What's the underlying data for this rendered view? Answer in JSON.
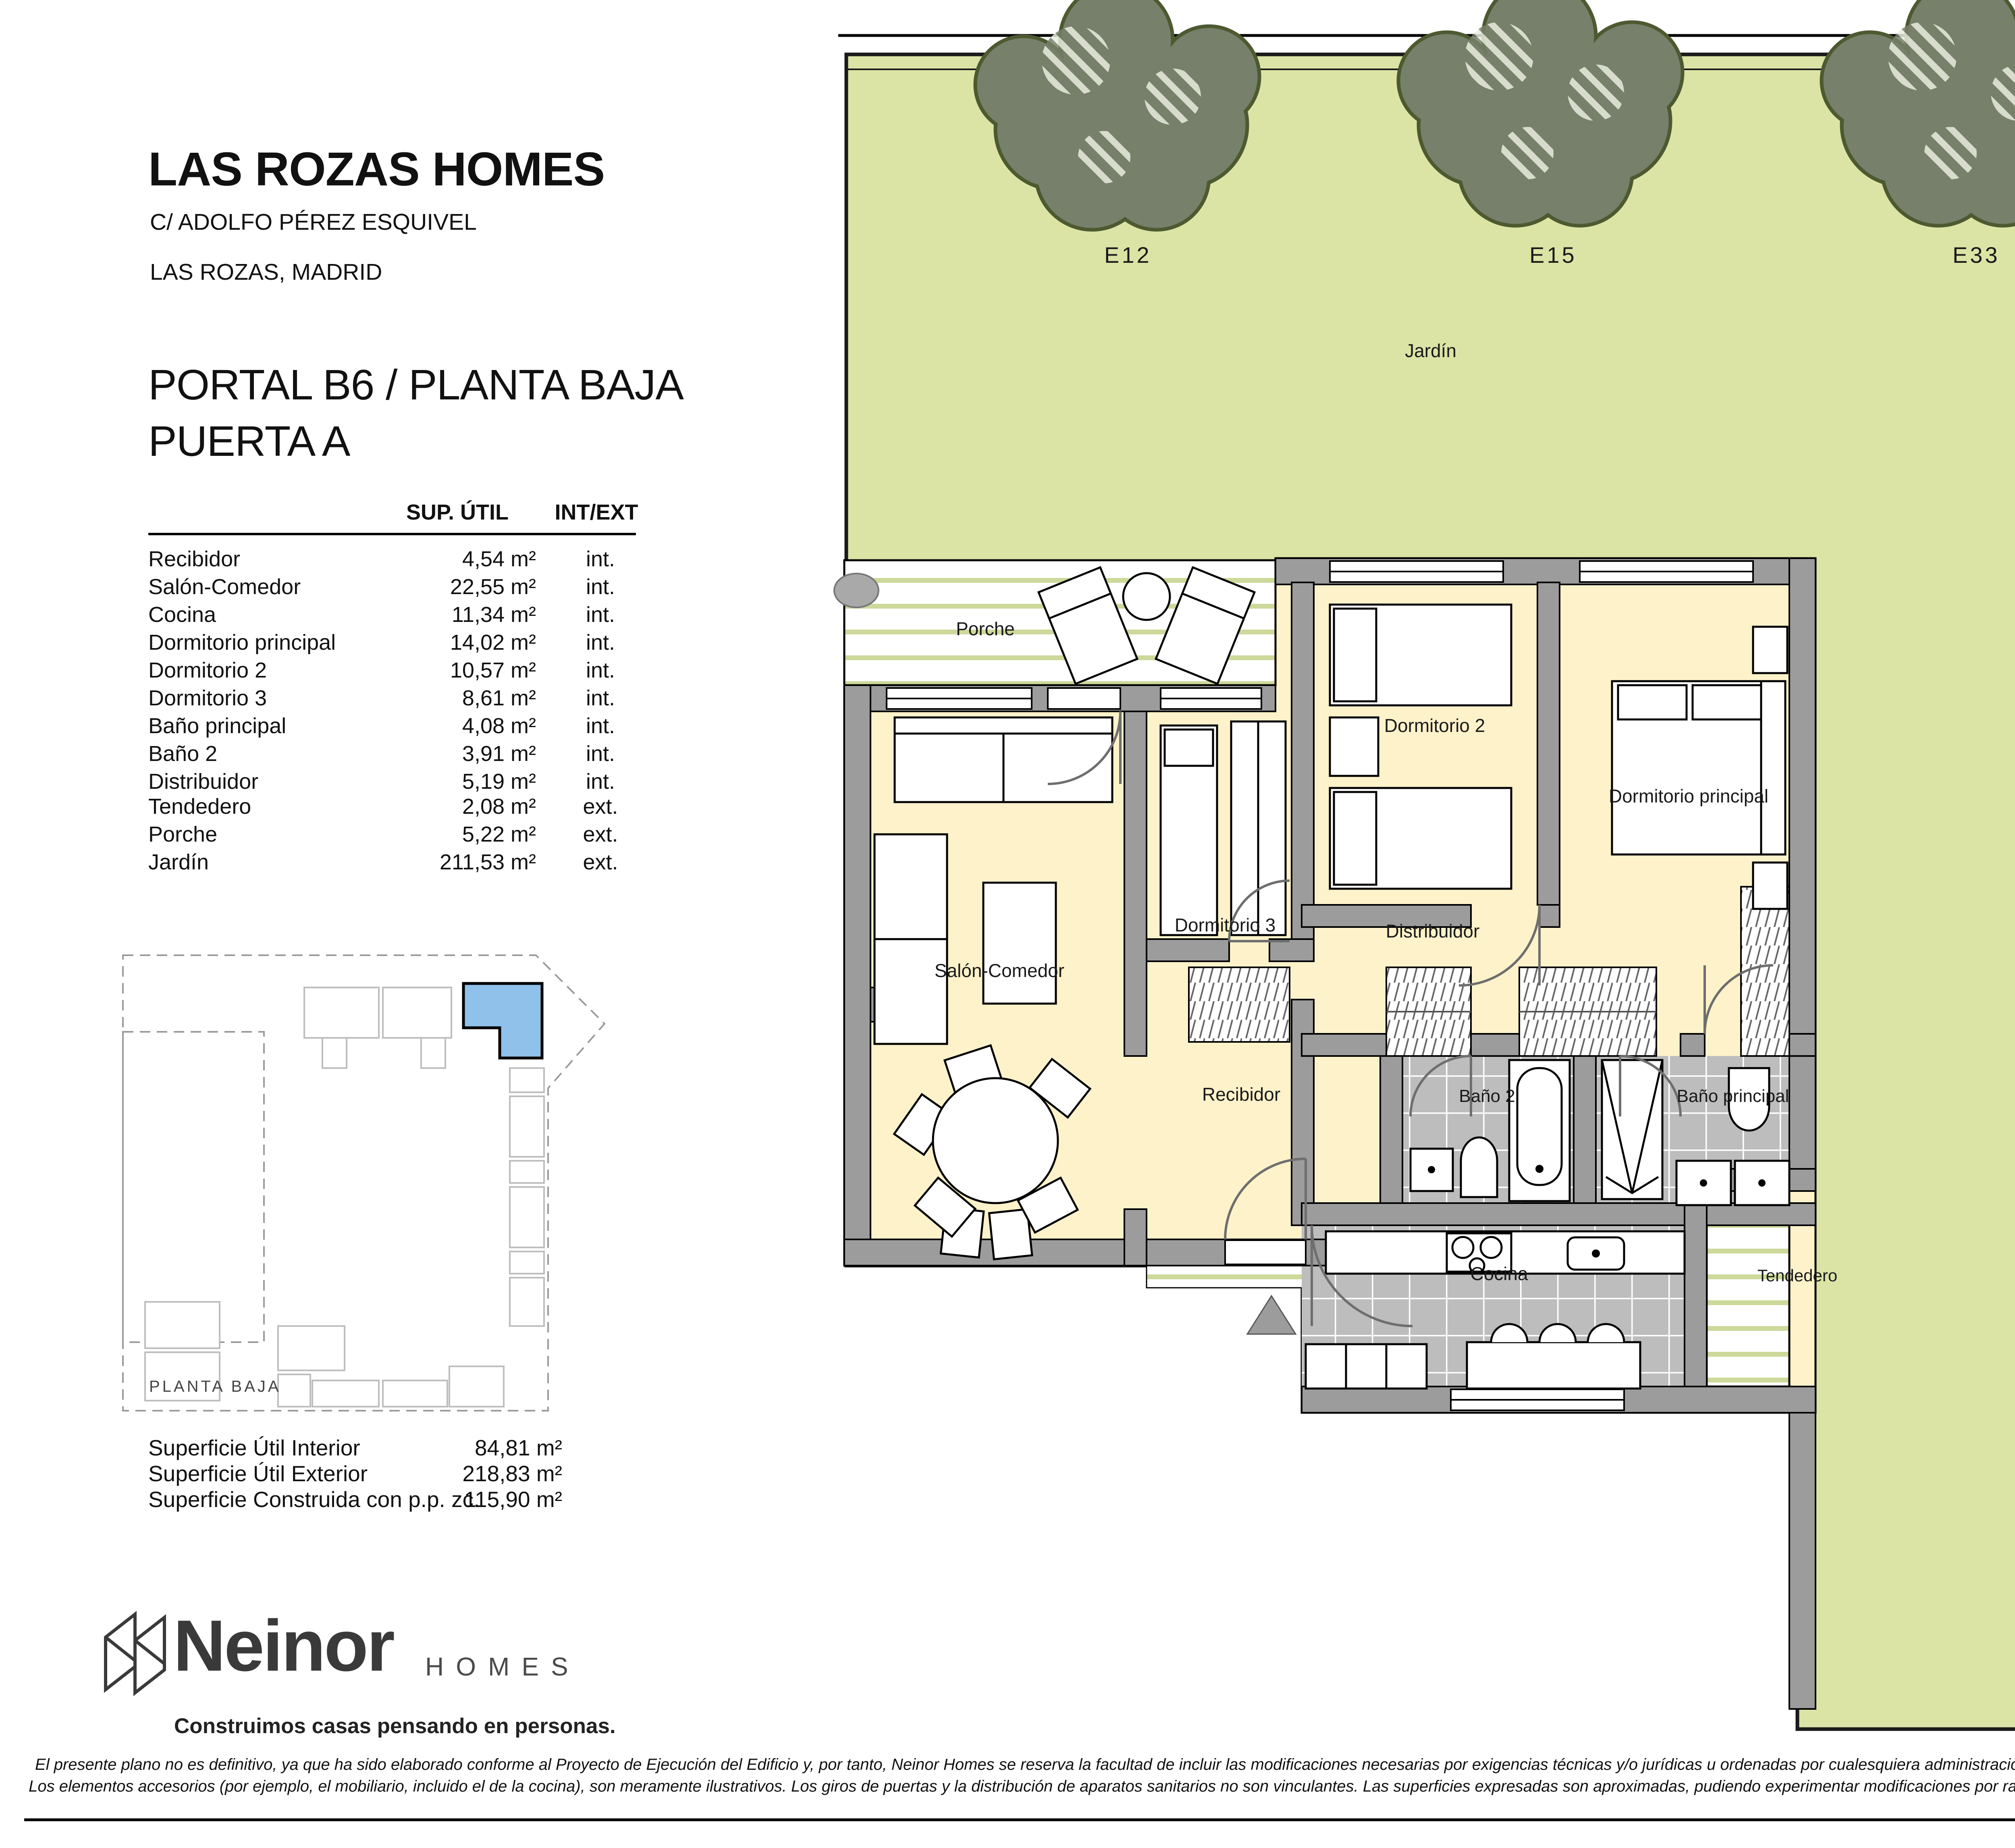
{
  "header": {
    "project": "LAS ROZAS HOMES",
    "address_line1": "C/ ADOLFO PÉREZ ESQUIVEL",
    "address_line2": "LAS ROZAS, MADRID",
    "unit_line1": "PORTAL B6 / PLANTA BAJA",
    "unit_line2": "PUERTA A"
  },
  "areas_table": {
    "col_area": "SUP. ÚTIL",
    "col_type": "INT/EXT",
    "rows": [
      {
        "name": "Recibidor",
        "area": "4,54 m²",
        "type": "int."
      },
      {
        "name": "Salón-Comedor",
        "area": "22,55 m²",
        "type": "int."
      },
      {
        "name": "Cocina",
        "area": "11,34 m²",
        "type": "int."
      },
      {
        "name": "Dormitorio principal",
        "area": "14,02 m²",
        "type": "int."
      },
      {
        "name": "Dormitorio 2",
        "area": "10,57 m²",
        "type": "int."
      },
      {
        "name": "Dormitorio 3",
        "area": "8,61 m²",
        "type": "int."
      },
      {
        "name": "Baño principal",
        "area": "4,08 m²",
        "type": "int."
      },
      {
        "name": "Baño 2",
        "area": "3,91 m²",
        "type": "int."
      },
      {
        "name": "Distribuidor",
        "area": "5,19 m²",
        "type": "int."
      },
      {
        "name": "Tendedero",
        "area": "2,08 m²",
        "type": "ext."
      },
      {
        "name": "Porche",
        "area": "5,22 m²",
        "type": "ext."
      },
      {
        "name": "Jardín",
        "area": "211,53 m²",
        "type": "ext."
      }
    ]
  },
  "key_plan": {
    "label": "PLANTA BAJA"
  },
  "summary": {
    "rows": [
      {
        "label": "Superficie Útil Interior",
        "value": "84,81 m²"
      },
      {
        "label": "Superficie Útil Exterior",
        "value": "218,83 m²"
      },
      {
        "label": "Superficie Construida con p.p. zc.",
        "value": "115,90 m²"
      }
    ]
  },
  "brand": {
    "name": "Neinor",
    "sub": "HOMES",
    "tagline": "Construimos casas pensando en personas."
  },
  "plan": {
    "trees": [
      "E12",
      "E15",
      "E33"
    ],
    "labels": {
      "jardin_top": "Jardín",
      "jardin_right": "Jardín",
      "porche": "Porche",
      "salon": "Salón-Comedor",
      "dormitorio2": "Dormitorio 2",
      "dormitorio3": "Dormitorio 3",
      "dormitorio_principal": "Dormitorio principal",
      "distribuidor": "Distribuidor",
      "recibidor": "Recibidor",
      "bano2": "Baño 2",
      "bano_principal": "Baño principal",
      "cocina": "Cocina",
      "tendedero": "Tendedero"
    },
    "version": "V.02 - DICIEMBRE 2024",
    "scale_label": "ESCALA GRÁFICA",
    "scale_ticks": [
      "0",
      "1",
      "2",
      "3"
    ]
  },
  "footer": {
    "line1": "El presente plano no es definitivo, ya que ha sido elaborado conforme al Proyecto de Ejecución del Edificio y, por tanto, Neinor Homes se reserva la facultad de incluir las modificaciones necesarias por exigencias técnicas y/o jurídicas u ordenadas por cualesquiera administraciones u organismos públicos, ajustándolo en todo caso al desarrollo de la obra.",
    "line2": "Los elementos accesorios (por ejemplo, el mobiliario, incluido el de la cocina), son meramente ilustrativos. Los giros de puertas y la distribución de aparatos sanitarios no son vinculantes. Las superficies expresadas son aproximadas, pudiendo experimentar modificaciones por razones de índole técnicas y/o legal en el desarrollo de la ejecución de las obras"
  },
  "colors": {
    "garden": "#dbe4a5",
    "tree": "#76806a",
    "tree_edge": "#4d5930",
    "room": "#fdf2ca",
    "wall": "#9c9c9c",
    "tile": "#bdbdbd",
    "deck_stripe": "#ccd99a",
    "unit_highlight": "#8fc1ea"
  }
}
